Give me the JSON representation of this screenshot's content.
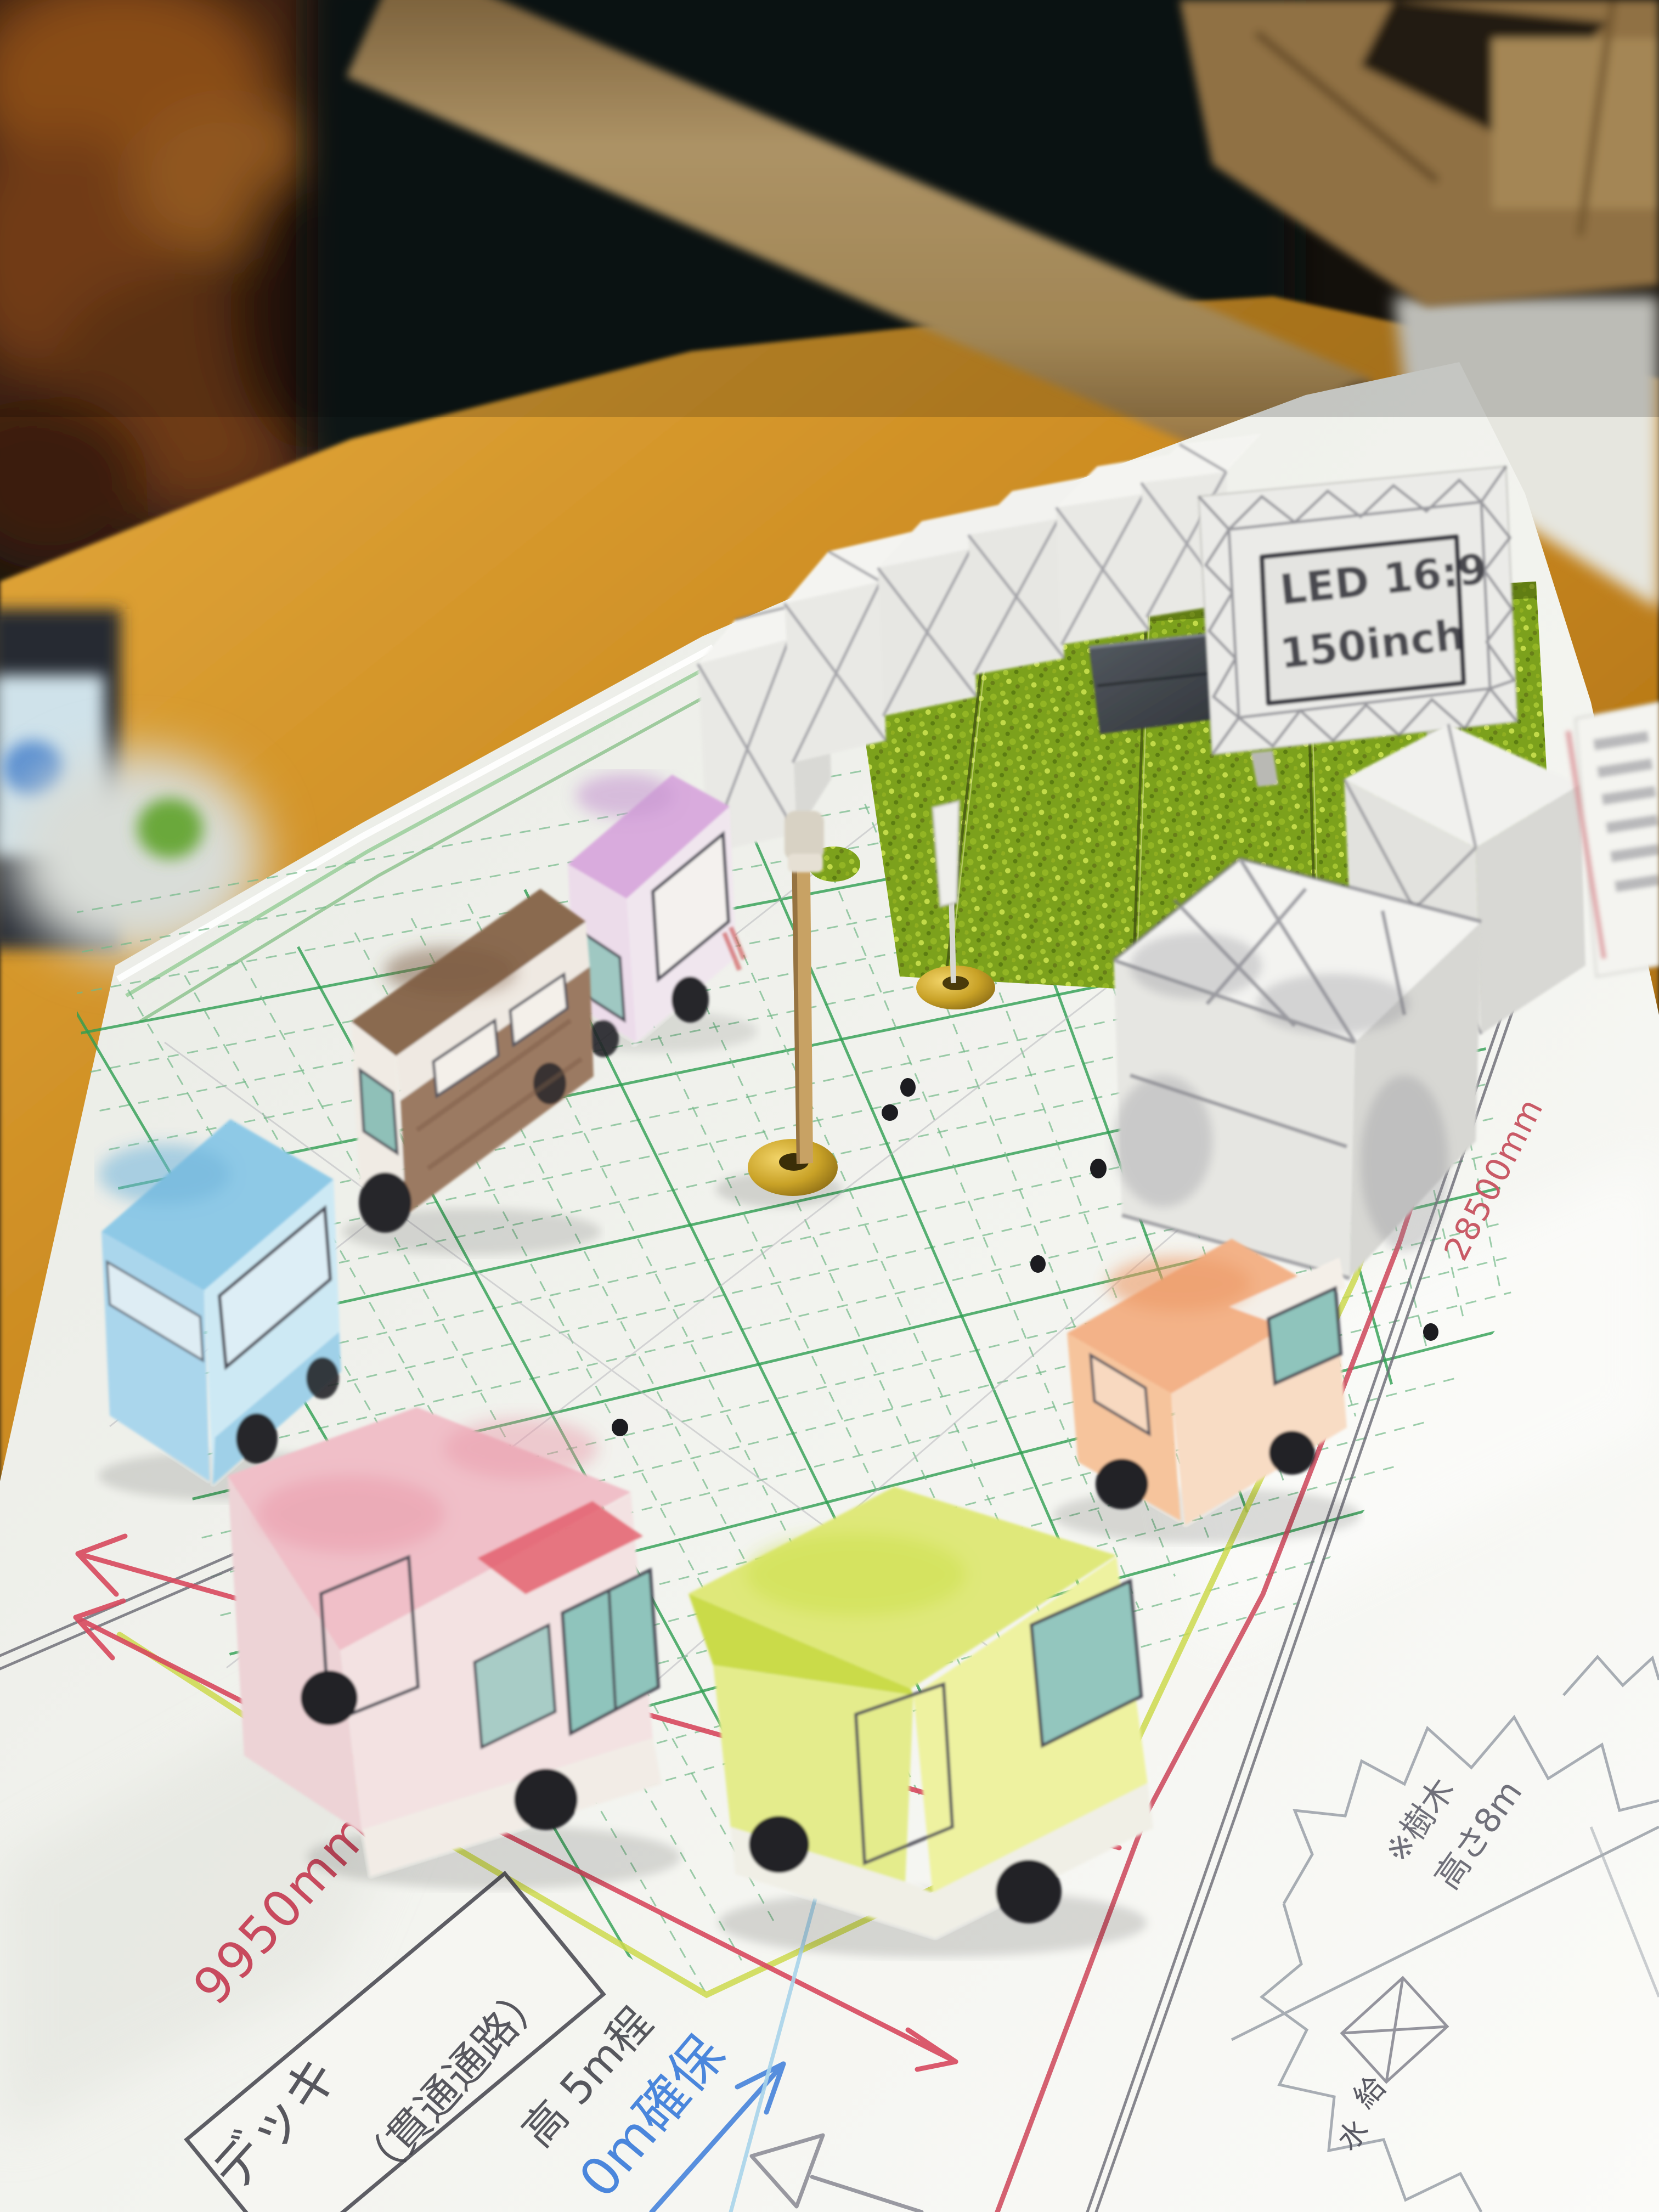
{
  "led_screen": {
    "line1": "LED 16:9",
    "line2": "150inch"
  },
  "dimensions": {
    "site_width": "9950mm",
    "site_length": "28500mm",
    "clearance_note": "0m確保"
  },
  "deck_label": {
    "line1": "デッキ",
    "line2": "（貫通通路）",
    "line3": "高 5m程"
  },
  "tree_note": {
    "prefix": "※樹木",
    "height": "高さ8m"
  },
  "water_supply": {
    "char1": "給",
    "char2": "水"
  },
  "colors": {
    "table_wood": "#c8861d",
    "paper": "#f0f1ec",
    "grid_major": "#2f9f52",
    "grid_minor": "#74b989",
    "dimension_red": "#d8495e",
    "pen_blue": "#4a86dc",
    "highlighter": "#ccd94e",
    "grass": "#7ca11c",
    "brass": "#c9a227"
  }
}
